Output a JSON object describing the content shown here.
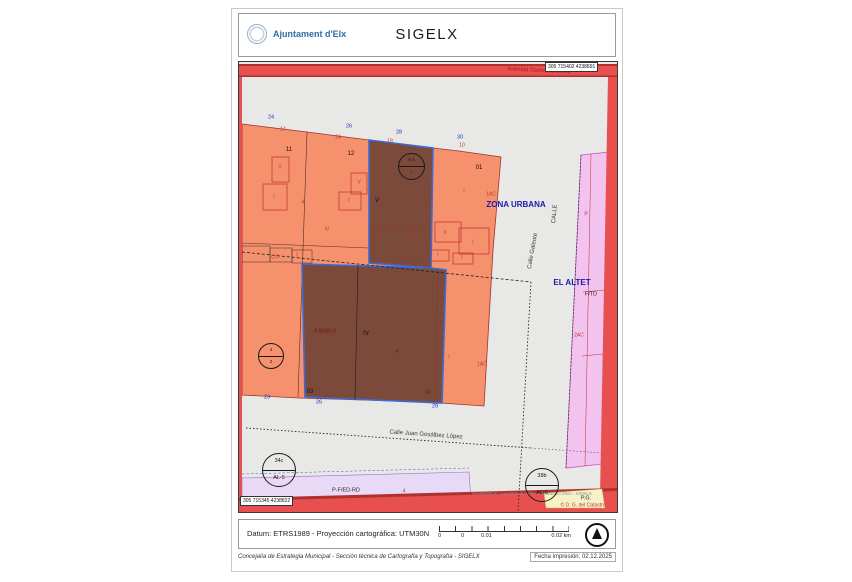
{
  "header": {
    "org": "Ajuntament d'Elx",
    "app_title": "SIGELX"
  },
  "map": {
    "coord_top_right": "305 715402 4238891",
    "coord_bottom_left": "305 715345 4238822",
    "colors": {
      "parcel_orange": "#f5916d",
      "selected_parcel_brown": "#7b4a3a",
      "selection_border_blue": "#3a6bd6",
      "street_red": "#e85050",
      "urban_pink": "#f2c3ee",
      "planning_lavender": "#e8d9f6",
      "planning_yellow": "#f5f2c8",
      "background_gray": "#e8e8e6",
      "number_blue": "#2233bb",
      "label_red": "#c23333",
      "zone_blue": "#1a1aaa"
    },
    "labels": [
      {
        "t": "Avenida Dama de Elche",
        "x": 300,
        "y": 9,
        "c": "street-red",
        "r": 3
      },
      {
        "t": "24",
        "x": 32,
        "y": 56,
        "c": "blue-num"
      },
      {
        "t": "26",
        "x": 110,
        "y": 65,
        "c": "blue-num"
      },
      {
        "t": "28",
        "x": 160,
        "y": 71,
        "c": "blue-num"
      },
      {
        "t": "30",
        "x": 221,
        "y": 76,
        "c": "blue-num"
      },
      {
        "t": "14",
        "x": 44,
        "y": 68,
        "c": "red-sm"
      },
      {
        "t": "24",
        "x": 99,
        "y": 76,
        "c": "red-sm"
      },
      {
        "t": "18",
        "x": 151,
        "y": 80,
        "c": "red-sm"
      },
      {
        "t": "10",
        "x": 223,
        "y": 84,
        "c": "red-sm"
      },
      {
        "t": "11",
        "x": 50,
        "y": 88,
        "c": "black-num"
      },
      {
        "t": "12",
        "x": 112,
        "y": 92,
        "c": "black-num"
      },
      {
        "t": "01",
        "x": 240,
        "y": 106,
        "c": "black-num"
      },
      {
        "t": "V",
        "x": 41,
        "y": 106,
        "c": "red-sm"
      },
      {
        "t": "I",
        "x": 35,
        "y": 136,
        "c": "red-sm"
      },
      {
        "t": "V",
        "x": 120,
        "y": 121,
        "c": "red-sm"
      },
      {
        "t": "I",
        "x": 110,
        "y": 139,
        "c": "red-sm"
      },
      {
        "t": "4",
        "x": 64,
        "y": 141,
        "c": "red-sm"
      },
      {
        "t": "IV",
        "x": 88,
        "y": 168,
        "c": "red-sm"
      },
      {
        "t": "CO",
        "x": 36,
        "y": 196,
        "c": "red-sm"
      },
      {
        "t": "I",
        "x": 58,
        "y": 194,
        "c": "red-sm"
      },
      {
        "t": "a",
        "x": 206,
        "y": 171,
        "c": "red-sm"
      },
      {
        "t": "I",
        "x": 234,
        "y": 181,
        "c": "red-sm"
      },
      {
        "t": "I",
        "x": 225,
        "y": 130,
        "c": "red-sm"
      },
      {
        "t": "1AC",
        "x": 252,
        "y": 133,
        "c": "red-sm"
      },
      {
        "t": "I",
        "x": 199,
        "y": 193,
        "c": "red-sm"
      },
      {
        "t": "I",
        "x": 223,
        "y": 196,
        "c": "red-sm"
      },
      {
        "t": "V",
        "x": 138,
        "y": 139,
        "c": "black-num"
      },
      {
        "t": "a",
        "x": 141,
        "y": 172,
        "c": "red-sm"
      },
      {
        "t": "CO",
        "x": 172,
        "y": 176,
        "c": "red-sm"
      },
      {
        "t": "4-SUELO",
        "x": 86,
        "y": 270,
        "c": "dark-red-sm"
      },
      {
        "t": "IV",
        "x": 127,
        "y": 272,
        "c": "black-num"
      },
      {
        "t": "a",
        "x": 158,
        "y": 290,
        "c": "dark-red-sm"
      },
      {
        "t": "03",
        "x": 71,
        "y": 330,
        "c": "black-num"
      },
      {
        "t": "02",
        "x": 189,
        "y": 331,
        "c": "dark-red-sm"
      },
      {
        "t": "23",
        "x": 28,
        "y": 336,
        "c": "blue-num"
      },
      {
        "t": "26",
        "x": 80,
        "y": 341,
        "c": "blue-num"
      },
      {
        "t": "29",
        "x": 196,
        "y": 345,
        "c": "blue-num"
      },
      {
        "t": "I",
        "x": 210,
        "y": 296,
        "c": "red-sm"
      },
      {
        "t": "1AC",
        "x": 243,
        "y": 303,
        "c": "red-sm"
      },
      {
        "t": "ZONA URBANA",
        "x": 277,
        "y": 143,
        "c": "zone"
      },
      {
        "t": "CALLE",
        "x": 316,
        "y": 152,
        "c": "street",
        "r": -85
      },
      {
        "t": "Calle Galeote",
        "x": 294,
        "y": 189,
        "c": "street",
        "r": -80
      },
      {
        "t": "EL ALTET",
        "x": 333,
        "y": 221,
        "c": "zone"
      },
      {
        "t": "F/TD",
        "x": 352,
        "y": 233,
        "c": "small-black"
      },
      {
        "t": "P",
        "x": 347,
        "y": 153,
        "c": "red-sm"
      },
      {
        "t": "2AC",
        "x": 340,
        "y": 274,
        "c": "red-sm"
      },
      {
        "t": "Calle Juan Gosálbez López",
        "x": 187,
        "y": 373,
        "c": "street",
        "r": 4
      },
      {
        "t": "P-F/ED-RD",
        "x": 107,
        "y": 429,
        "c": "small-black"
      },
      {
        "t": "4",
        "x": 165,
        "y": 430,
        "c": "red-sm"
      },
      {
        "t": "P.G.",
        "x": 347,
        "y": 437,
        "c": "small-black"
      },
      {
        "t": "© D. G. del Catastro",
        "x": 344,
        "y": 444,
        "c": "red-sm"
      },
      {
        "t": "GeoSIGELX - Ajuntament d'Elx - Ajuntament d'Elx - SIGELX",
        "x": 293,
        "y": 432,
        "c": "attr"
      }
    ],
    "symbols": [
      {
        "top": "5 a",
        "bottom": "I",
        "x": 159,
        "y": 91,
        "d": 27,
        "fs": 4.5
      },
      {
        "top": "4",
        "bottom": "2",
        "x": 19,
        "y": 281,
        "d": 26,
        "fs": 4.5
      },
      {
        "top": "34c",
        "bottom": "AL-5",
        "x": 23,
        "y": 391,
        "d": 34,
        "fs": 5.5
      },
      {
        "top": "38b",
        "bottom": "AL-6",
        "x": 286,
        "y": 406,
        "d": 34,
        "fs": 5.5
      }
    ]
  },
  "footer": {
    "datum": "Datum: ETRS1989 - Proyección cartográfica: UTM30N",
    "scale_ticks": [
      "0",
      "0",
      "0.01",
      "0.02 km"
    ],
    "department": "Concejalía de Estrategia Municipal - Sección técnica de Cartografía y Topografía - SIGELX",
    "print_date": "Fecha impresión: 02.12.2025"
  }
}
